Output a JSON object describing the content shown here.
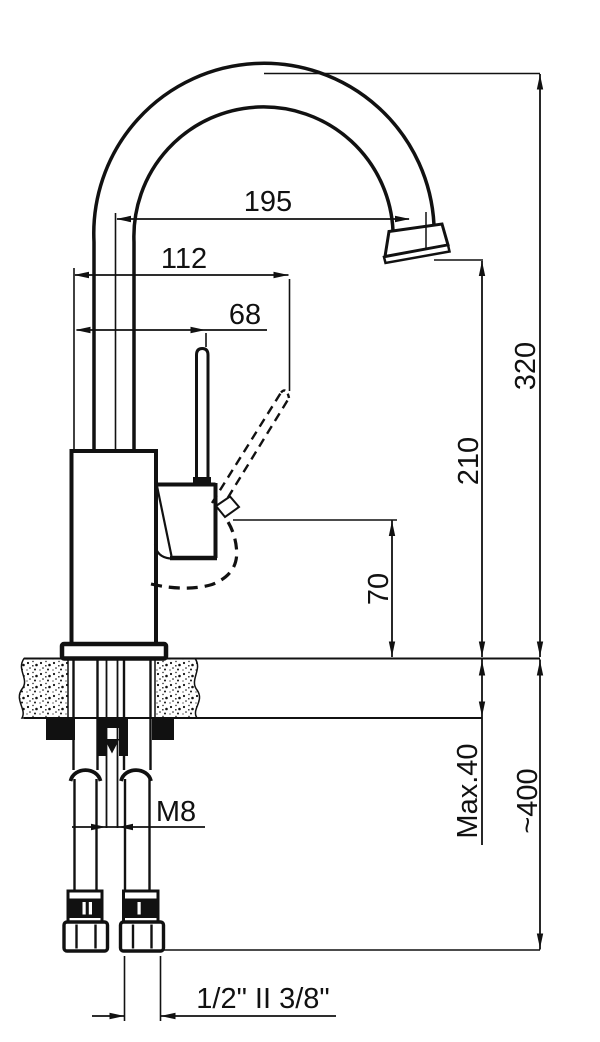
{
  "dims": {
    "spout_reach": "195",
    "handle_reach": "112",
    "handle_offset": "68",
    "overall_height": "320",
    "outlet_height": "210",
    "body_height": "70",
    "max_counter_thickness": "Max.40",
    "hose_length": "~400",
    "stud_thread": "M8",
    "hose_threads": "1/2\" II 3/8\""
  }
}
